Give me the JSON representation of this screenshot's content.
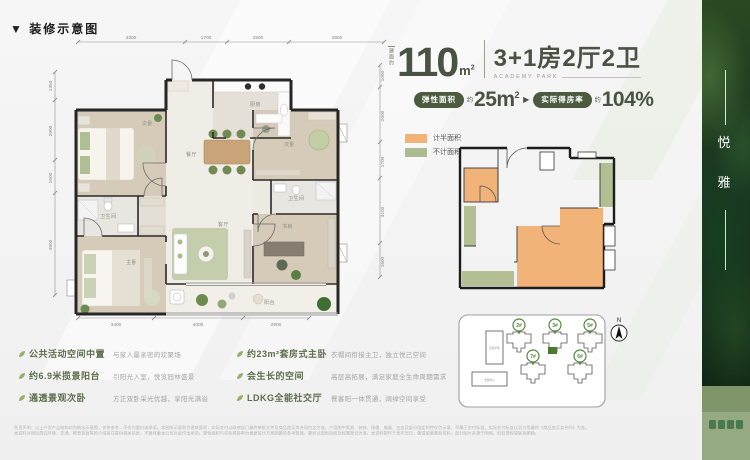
{
  "colors": {
    "accent": "#4c5a40",
    "orange": "#f1b377",
    "legend_green": "#aebb90",
    "pin_green": "#55853a"
  },
  "section_title": "▼ 装修示意图",
  "header": {
    "area_prefix": "建面约",
    "area_number": "110",
    "area_unit": "m",
    "area_sup": "2",
    "layout_text": "3+1房2厅2卫",
    "subtitle": "ACADEMY PARK",
    "badge1_label": "弹性面积",
    "badge1_approx": "约",
    "badge1_value": "25m",
    "badge1_sup": "2",
    "arrow": "▶",
    "badge2_label": "实际得房率",
    "badge2_approx": "约",
    "badge2_value": "104%"
  },
  "legend": {
    "half_label": "计半面积",
    "none_label": "不计面积"
  },
  "floorplan": {
    "dims_top": [
      "4300",
      "1700",
      "2500",
      "3800"
    ],
    "dims_bottom": [
      "3400",
      "4000",
      "2900"
    ],
    "dims_left": [
      "1350",
      "2900",
      "1600",
      "4900"
    ],
    "dims_right": [
      "1050",
      "2600",
      "1700",
      "3100",
      "1600"
    ],
    "rooms": {
      "bed_tl": "次卧",
      "kitchen": "厨房",
      "dining": "餐厅",
      "bed_tr": "次卧",
      "bath1": "卫生间",
      "bath2": "卫生间",
      "master": "主卧",
      "living": "客厅",
      "study": "书房",
      "balcony": "阳台"
    }
  },
  "siteplan": {
    "north": "N",
    "buildings": [
      "2#",
      "3#",
      "5#",
      "7#",
      "6#"
    ],
    "facility_top": "实验学校",
    "facility_bottom": "会所中心"
  },
  "features": {
    "col1": [
      {
        "title": "公共活动空间中置",
        "desc": "与家人最亲密的欢聚场"
      },
      {
        "title": "约6.9米揽景阳台",
        "desc": "引阳光入室，悦览园林盛景"
      },
      {
        "title": "通透景观次卧",
        "desc": "方正双卧采光优越，享阳光满溢"
      }
    ],
    "col2": [
      {
        "title": "约23m²套房式主卧",
        "desc": "衣帽间衔接主卫，独立悦己空间"
      },
      {
        "title": "会生长的空间",
        "desc": "高层高拓展，满足家庭全生命周期需求"
      },
      {
        "title": "LDKG全能社交厅",
        "desc": "餐客阳一体贯通，阔绰空间享受"
      }
    ]
  },
  "side": {
    "char1": "悦",
    "char2": "雅"
  },
  "disclaimer": {
    "line1": "免责声明：以上户型产品结构均为概念示意图，仅供参考，不作为要约或承诺。本图所示面积为建筑面积，实际交付以政府部门最终审批文件及商品房买卖合同约定为准。户型图中家具、装饰、绿植、电器、五金及部分固定构件仅为示意，不属于交付标准，实际交付标准以双方签署的《商品房买卖合同》为准。",
    "line2": "本资料对项目周边环境、交通、教育资源等的介绍旨在提供相关信息，不意味着本公司对此作出承诺。弹性面积与实际得房率为根据设计方案测算的参考数值，最终以规划验收及权属登记为准。本资料制作于发布当日，敬请留意最新资料，部分图片来源于网络，如有侵权请联系删除。"
  }
}
